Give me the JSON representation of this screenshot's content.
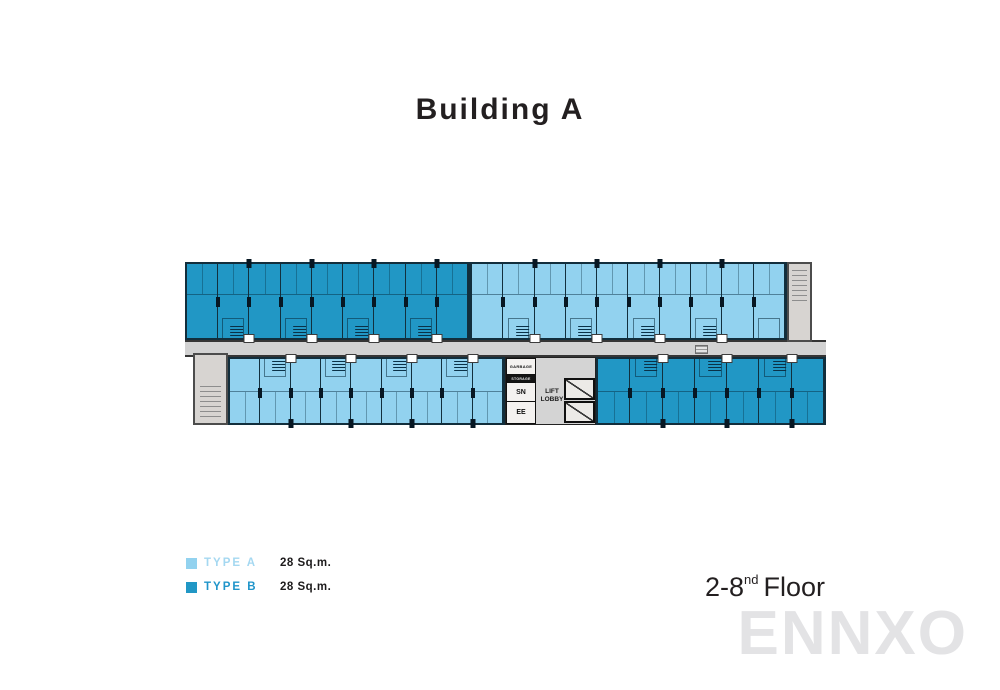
{
  "title": "Building A",
  "floor": {
    "range": "2-8",
    "sup": "nd",
    "word": "Floor"
  },
  "watermark": "ENNXO",
  "legend": {
    "items": [
      {
        "label": "TYPE A",
        "area": "28 Sq.m.",
        "swatch": "#92d2ef",
        "text_color": "#a5d8f1"
      },
      {
        "label": "TYPE B",
        "area": "28 Sq.m.",
        "swatch": "#2197c5",
        "text_color": "#2095ca"
      }
    ]
  },
  "core": {
    "rooms": [
      "GARBAGE",
      "STORAGE",
      "SN",
      "EE"
    ],
    "lobby": "LIFT LOBBY"
  },
  "plan": {
    "colors": {
      "type_a": "#92d2ef",
      "type_b": "#2197c5",
      "wall": "#12303e",
      "corridor": "#d2d2d2",
      "stair": "#d7d4d1"
    },
    "bands": [
      {
        "id": "top-b-units",
        "type": "unit-type-b",
        "count": 9,
        "color": "#2197c5"
      },
      {
        "id": "top-a-units",
        "type": "unit-type-a",
        "count": 10,
        "color": "#92d2ef"
      },
      {
        "id": "bot-a-units",
        "type": "unit-type-a",
        "count": 9,
        "color": "#92d2ef"
      },
      {
        "id": "bot-b-units",
        "type": "unit-type-b",
        "count": 7,
        "color": "#2197c5"
      }
    ]
  }
}
